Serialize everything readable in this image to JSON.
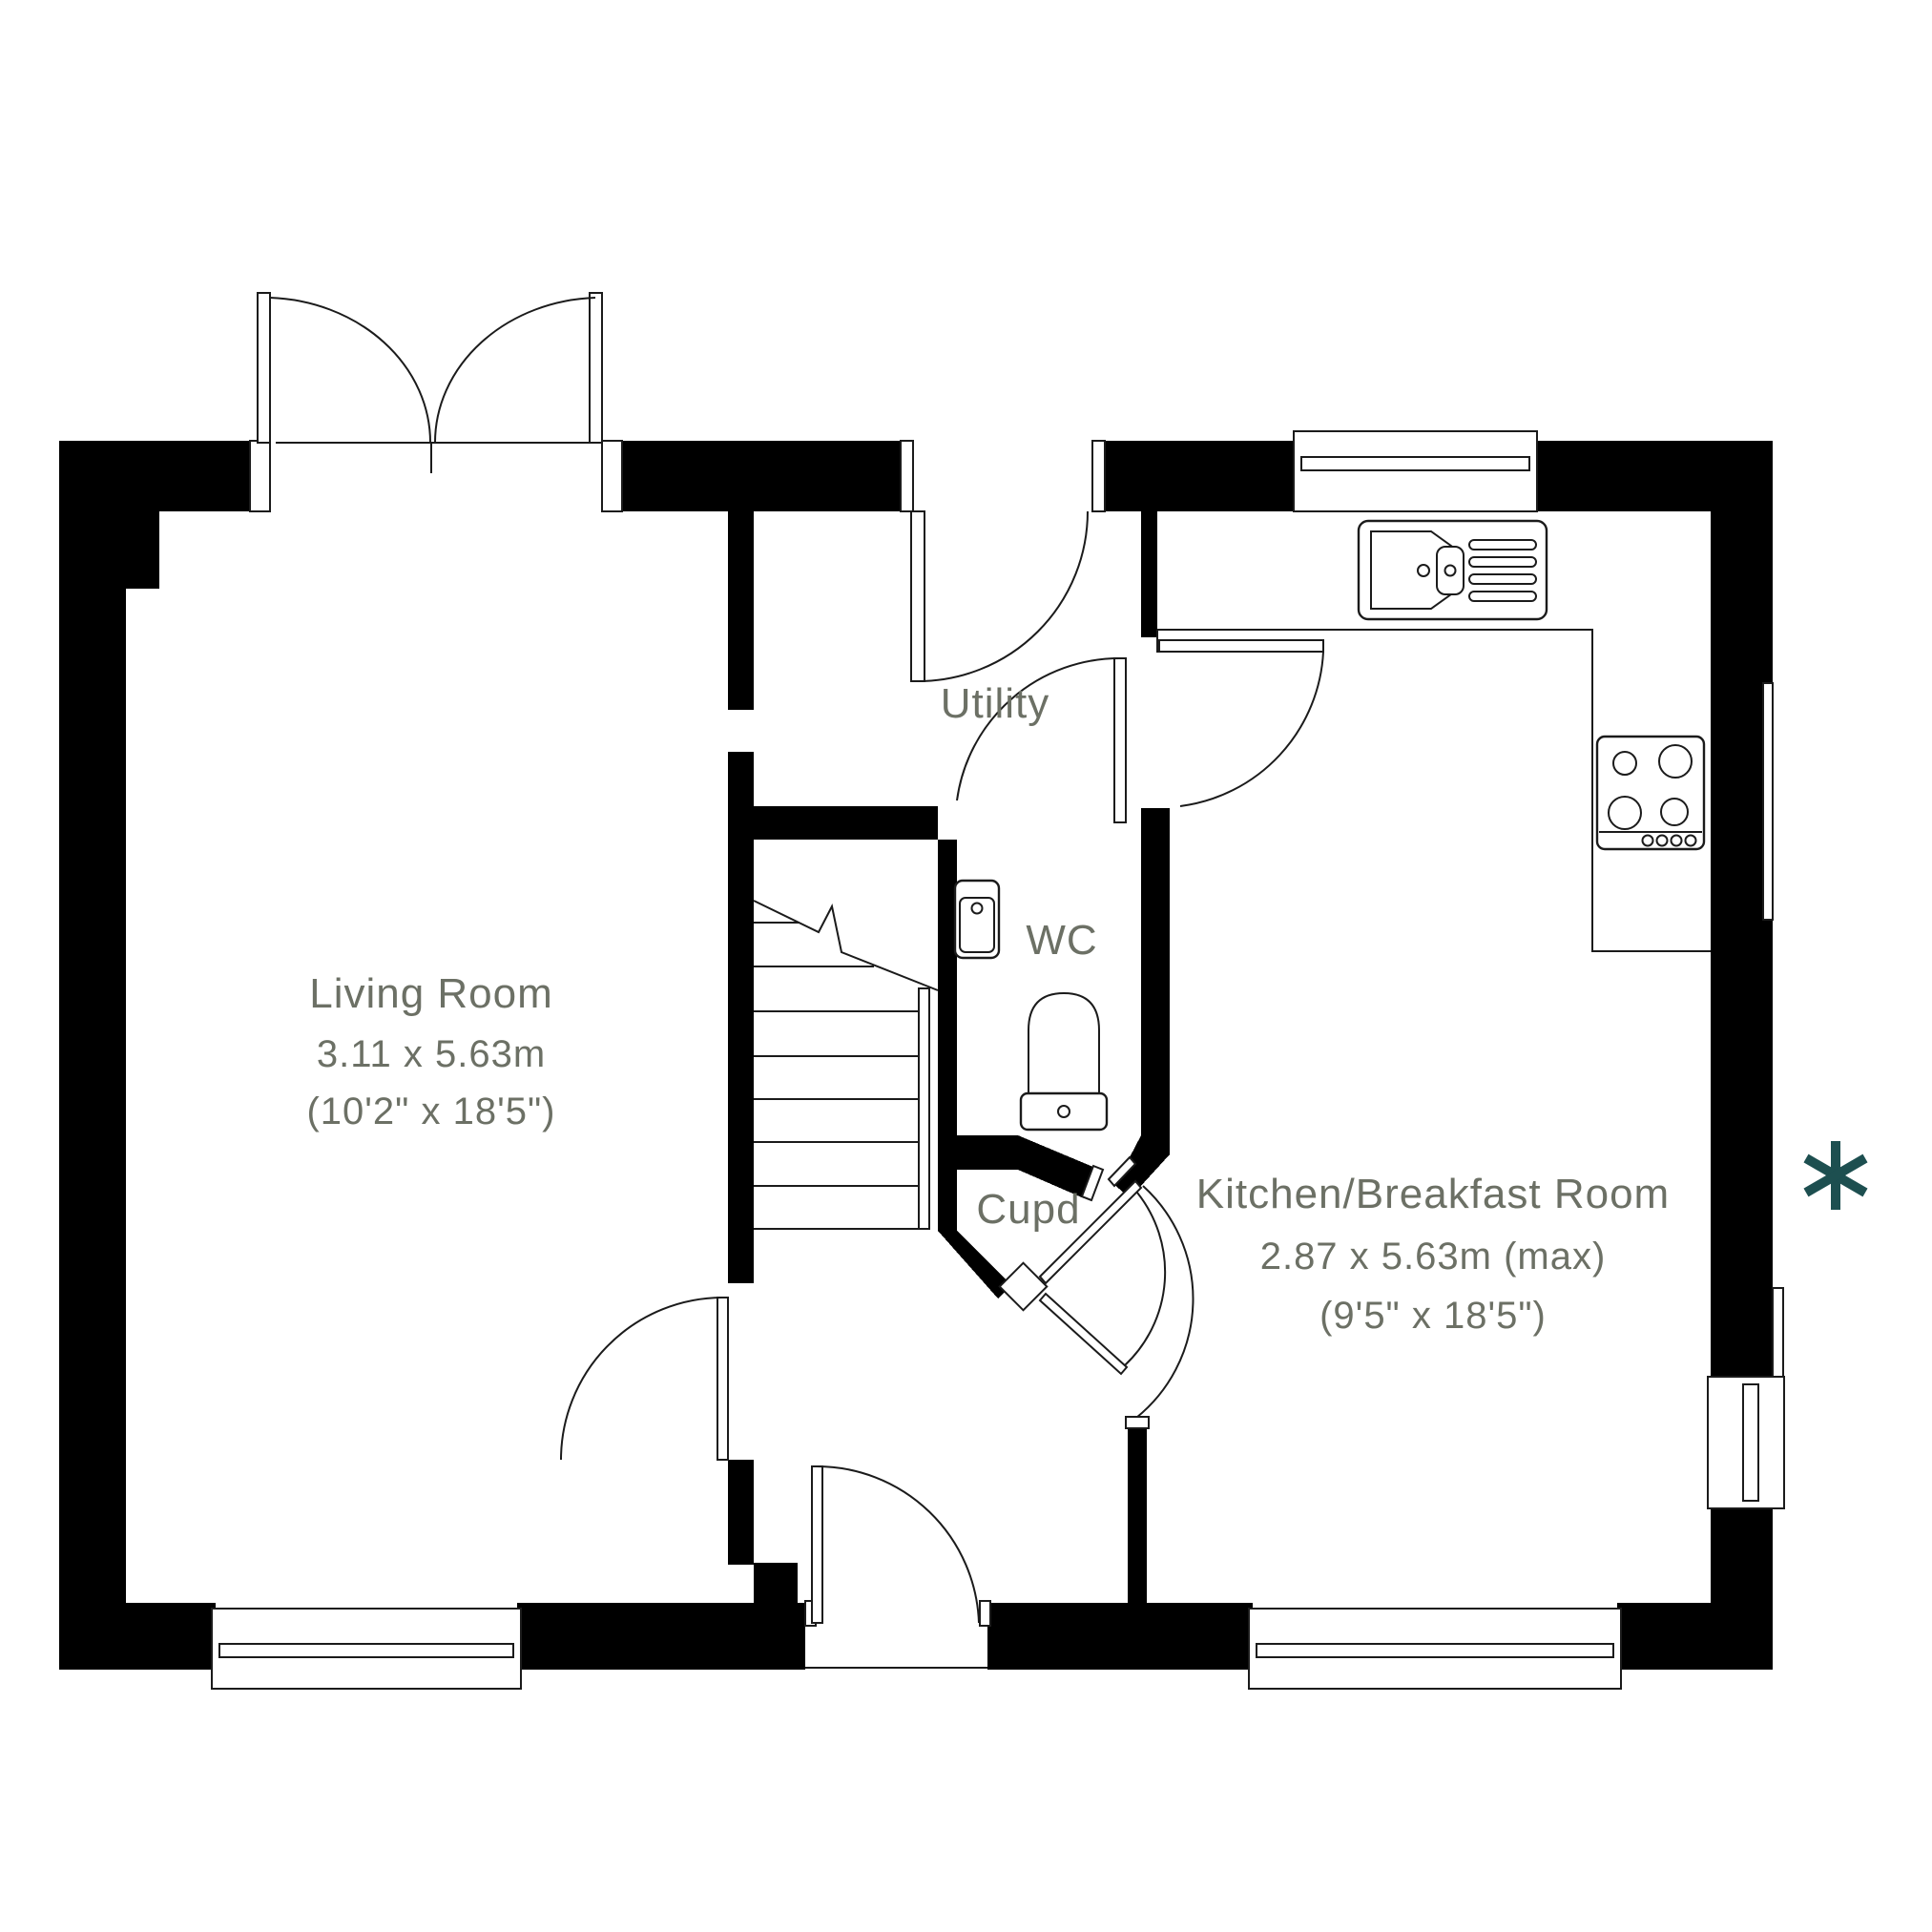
{
  "plan": {
    "type": "floor-plan",
    "rooms": [
      {
        "id": "living",
        "name": "Living Room",
        "dims_metric": "3.11 x 5.63m",
        "dims_imperial": "(10'2\" x 18'5\")"
      },
      {
        "id": "utility",
        "name": "Utility"
      },
      {
        "id": "wc",
        "name": "WC"
      },
      {
        "id": "cupd",
        "name": "Cupd"
      },
      {
        "id": "kitchen",
        "name": "Kitchen/Breakfast Room",
        "dims_metric": "2.87 x 5.63m (max)",
        "dims_imperial": "(9'5\" x 18'5\")"
      }
    ],
    "fixtures": [
      "kitchen-sink",
      "hob",
      "wash-basin",
      "toilet",
      "staircase",
      "kitchen-counter"
    ],
    "annotations": {
      "asterisk": "*"
    },
    "colors": {
      "wall": "#000000",
      "line": "#1b1b1b",
      "label": "#6c7065",
      "accent": "#1d4f50"
    }
  }
}
